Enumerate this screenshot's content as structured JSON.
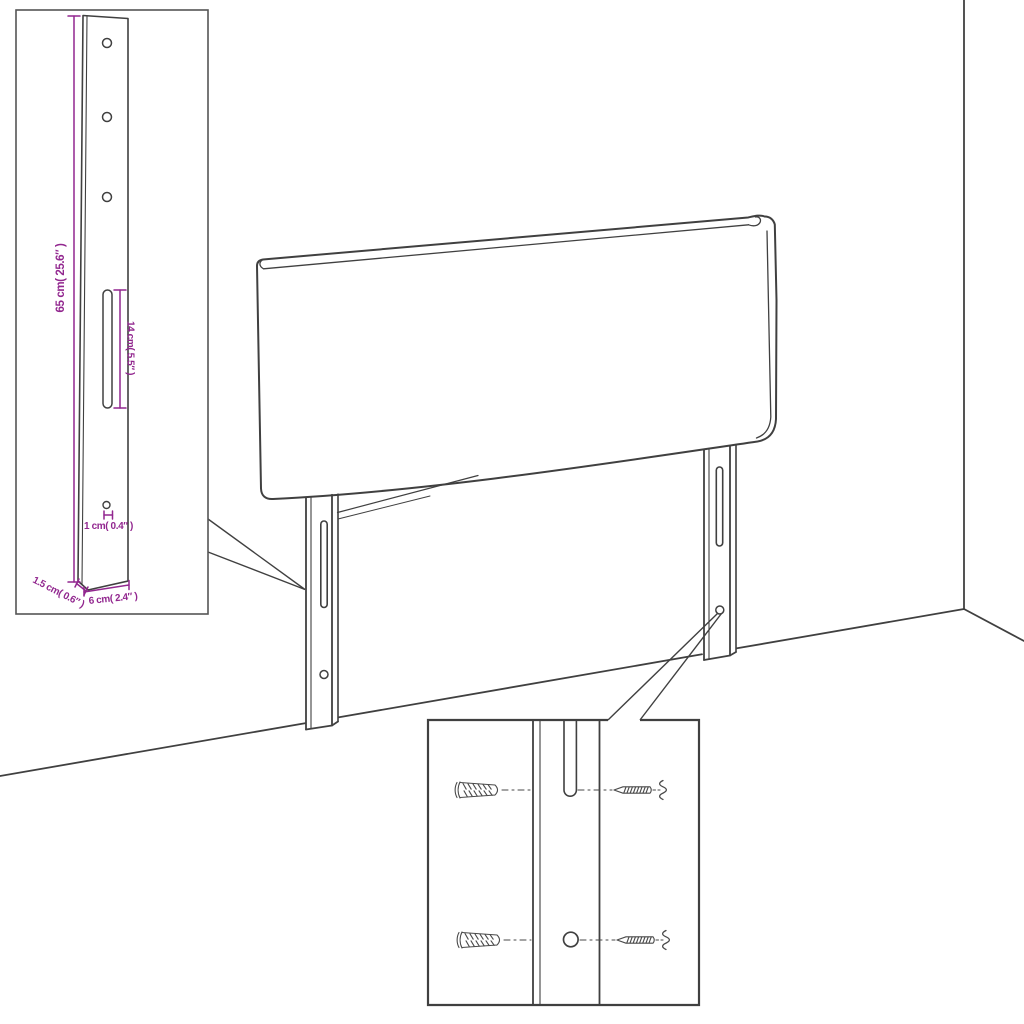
{
  "annotations": {
    "bracket_height": "65 cm( 25.6″ )",
    "slot_length": "14 cm( 5.5″ )",
    "hole_diameter": "1 cm( 0.4″ )",
    "bracket_thickness": "1.5 cm( 0.6″ )",
    "bracket_width": "6 cm( 2.4″ )"
  },
  "colors": {
    "dimension_accent": "#92278F",
    "line": "#404040",
    "hardware_line": "#4A4A4A",
    "background": "#FFFFFF"
  }
}
